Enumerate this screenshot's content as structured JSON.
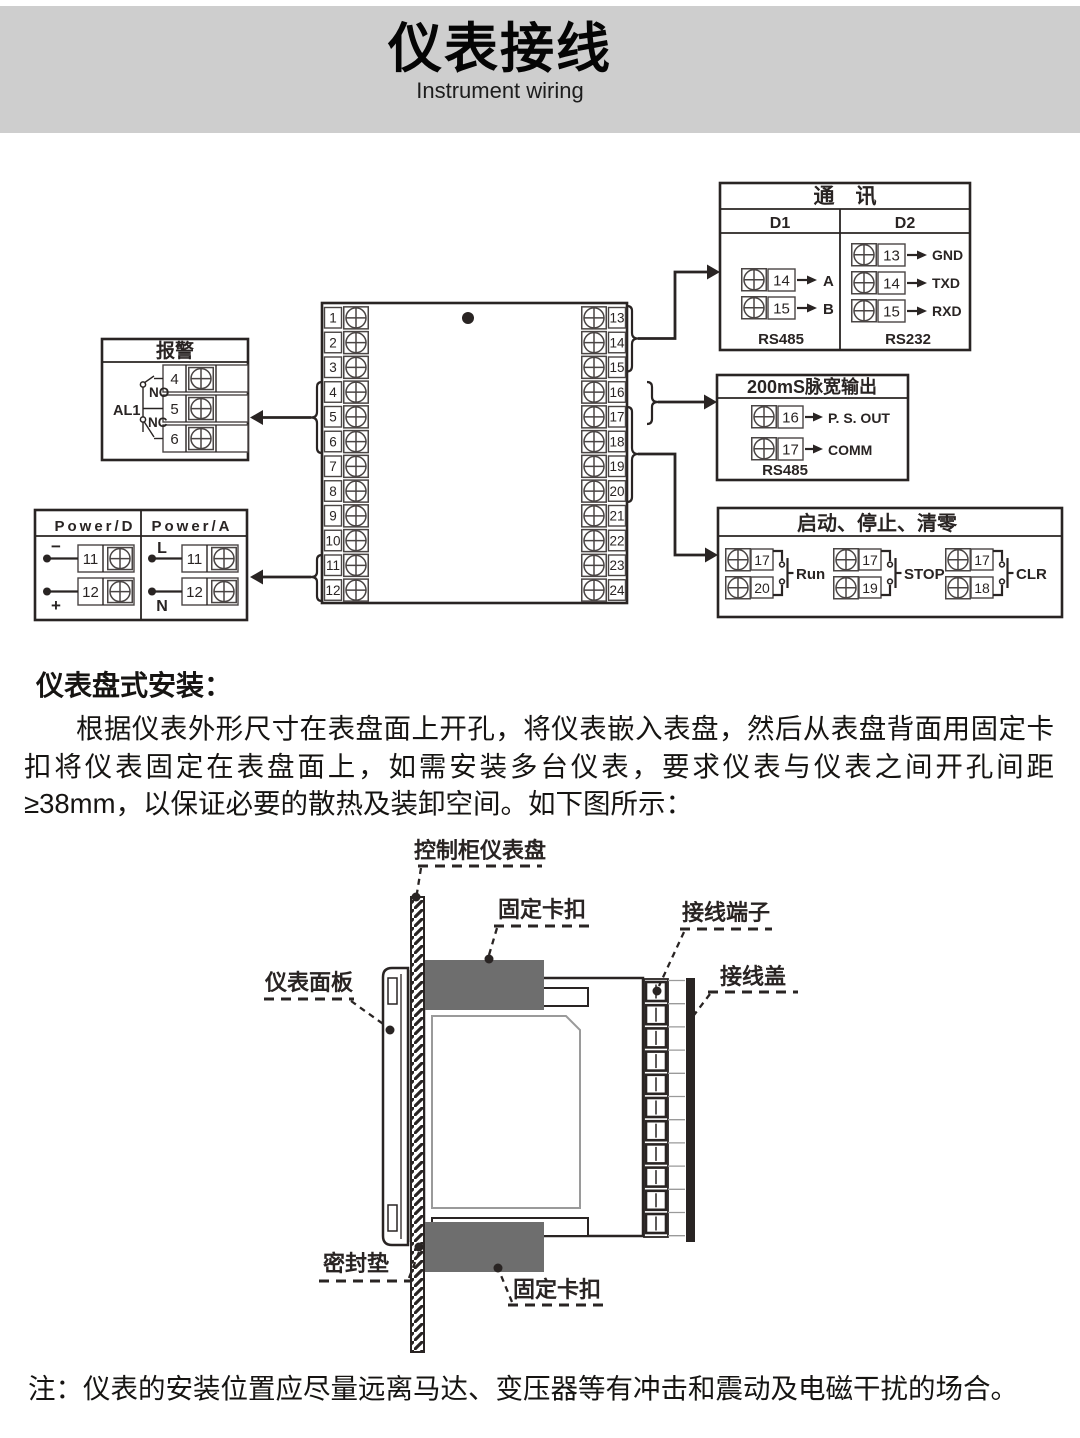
{
  "header": {
    "title": "仪表接线",
    "subtitle": "Instrument wiring"
  },
  "wiring": {
    "main_block": {
      "left": [
        "1",
        "2",
        "3",
        "4",
        "5",
        "6",
        "7",
        "8",
        "9",
        "10",
        "11",
        "12"
      ],
      "right": [
        "13",
        "14",
        "15",
        "16",
        "17",
        "18",
        "19",
        "20",
        "21",
        "22",
        "23",
        "24"
      ]
    },
    "comm": {
      "title": "通　讯",
      "d1": {
        "label": "D1",
        "rows": [
          {
            "num": "14",
            "target": "A"
          },
          {
            "num": "15",
            "target": "B"
          }
        ],
        "bus": "RS485"
      },
      "d2": {
        "label": "D2",
        "rows": [
          {
            "num": "13",
            "target": "GND"
          },
          {
            "num": "14",
            "target": "TXD"
          },
          {
            "num": "15",
            "target": "RXD"
          }
        ],
        "bus": "RS232"
      }
    },
    "alarm": {
      "title": "报警",
      "relay": "AL1",
      "no_label": "NO",
      "nc_label": "NC",
      "terminals": [
        "4",
        "5",
        "6"
      ]
    },
    "pulse": {
      "title": "200mS脉宽输出",
      "rows": [
        {
          "num": "16",
          "target": "P. S. OUT"
        },
        {
          "num": "17",
          "target": "COMM"
        }
      ],
      "bus": "RS485"
    },
    "power": {
      "d_label": "Power/D",
      "a_label": "Power/A",
      "d_rows": [
        {
          "sign": "−",
          "num": "11"
        },
        {
          "sign": "+",
          "num": "12"
        }
      ],
      "a_rows": [
        {
          "sign": "L",
          "num": "11"
        },
        {
          "sign": "N",
          "num": "12"
        }
      ]
    },
    "control": {
      "title": "启动、停止、清零",
      "groups": [
        {
          "top": "17",
          "bottom": "20",
          "label": "Run"
        },
        {
          "top": "17",
          "bottom": "19",
          "label": "STOP"
        },
        {
          "top": "17",
          "bottom": "18",
          "label": "CLR"
        }
      ]
    }
  },
  "install": {
    "heading": "仪表盘式安装：",
    "paragraph": "根据仪表外形尺寸在表盘面上开孔，将仪表嵌入表盘，然后从表盘背面用固定卡扣将仪表固定在表盘面上，如需安装多台仪表，要求仪表与仪表之间开孔间距≥38mm，以保证必要的散热及装卸空间。如下图所示：",
    "labels": {
      "panel": "控制柜仪表盘",
      "clip_top": "固定卡扣",
      "terminal": "接线端子",
      "cover": "接线盖",
      "front": "仪表面板",
      "gasket": "密封垫",
      "clip_bottom": "固定卡扣"
    }
  },
  "note": "注：仪表的安装位置应尽量远离马达、变压器等有冲击和震动及电磁干扰的场合。",
  "colors": {
    "band_gray": "#cecece",
    "ink": "#292423",
    "clip_gray": "#6e6e6e",
    "gasket_gray": "#c9c9c9"
  }
}
